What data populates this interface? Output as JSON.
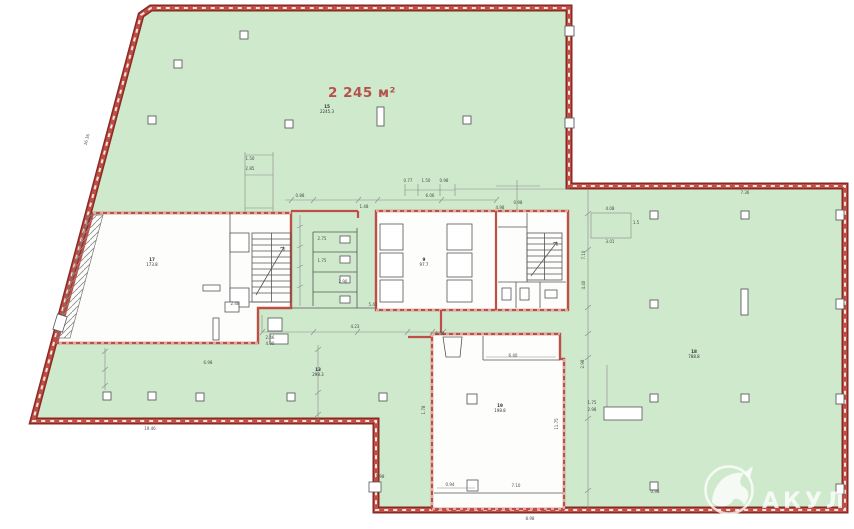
{
  "labels": {
    "area_total": "2 245 м²",
    "watermark": "АКУЛА"
  },
  "colors": {
    "floor_green": "#cfe9cd",
    "wall_red": "#bf4f44",
    "wall_dark": "#8a2a24",
    "annotation_ink": "#4a4a4a",
    "area_label_red": "#b4524c",
    "watermark_white": "#ffffff"
  },
  "room_labels": [
    {
      "x": 327,
      "y": 108,
      "id": "15",
      "area": "2245.3"
    },
    {
      "x": 152,
      "y": 261,
      "id": "17",
      "area": "173.8"
    },
    {
      "x": 424,
      "y": 261,
      "id": "9",
      "area": "97.7"
    },
    {
      "x": 318,
      "y": 371,
      "id": "13",
      "area": "298.3"
    },
    {
      "x": 500,
      "y": 407,
      "id": "19",
      "area": "198.8"
    },
    {
      "x": 694,
      "y": 353,
      "id": "18",
      "area": "788.8"
    }
  ],
  "annotations": [
    {
      "x": 250,
      "y": 160,
      "t": "1.50"
    },
    {
      "x": 250,
      "y": 170,
      "t": "2.85"
    },
    {
      "x": 300,
      "y": 197,
      "t": "0.88"
    },
    {
      "x": 364,
      "y": 208,
      "t": "1.48"
    },
    {
      "x": 430,
      "y": 197,
      "t": "6.06"
    },
    {
      "x": 408,
      "y": 182,
      "t": "0.77"
    },
    {
      "x": 426,
      "y": 182,
      "t": "1.50"
    },
    {
      "x": 444,
      "y": 182,
      "t": "0.98"
    },
    {
      "x": 500,
      "y": 209,
      "t": "4.98"
    },
    {
      "x": 518,
      "y": 204,
      "t": "0.98"
    },
    {
      "x": 513,
      "y": 357,
      "t": "6.40"
    },
    {
      "x": 516,
      "y": 487,
      "t": "7.10"
    },
    {
      "x": 450,
      "y": 486,
      "t": "0.94"
    },
    {
      "x": 440,
      "y": 335,
      "t": "1.88"
    },
    {
      "x": 322,
      "y": 240,
      "t": "2.75"
    },
    {
      "x": 322,
      "y": 262,
      "t": "1.75"
    },
    {
      "x": 343,
      "y": 283,
      "t": "2.90"
    },
    {
      "x": 373,
      "y": 306,
      "t": "5.41"
    },
    {
      "x": 235,
      "y": 305,
      "t": "2.48"
    },
    {
      "x": 270,
      "y": 339,
      "t": "2.46"
    },
    {
      "x": 270,
      "y": 345,
      "t": "4.90"
    },
    {
      "x": 355,
      "y": 328,
      "t": "4.23"
    },
    {
      "x": 208,
      "y": 364,
      "t": "6.98"
    },
    {
      "x": 592,
      "y": 404,
      "t": "1.75"
    },
    {
      "x": 592,
      "y": 411,
      "t": "2.98"
    },
    {
      "x": 610,
      "y": 210,
      "t": "4.08"
    },
    {
      "x": 610,
      "y": 243,
      "t": "3.01"
    },
    {
      "x": 636,
      "y": 224,
      "t": "1.5"
    },
    {
      "x": 745,
      "y": 194,
      "t": "7.36"
    },
    {
      "x": 655,
      "y": 493,
      "t": "0.98"
    },
    {
      "x": 150,
      "y": 430,
      "t": "19.46"
    },
    {
      "x": 530,
      "y": 520,
      "t": "8.98"
    },
    {
      "x": 380,
      "y": 478,
      "t": "1.98"
    },
    {
      "x": 585,
      "y": 255,
      "t": "7.10",
      "r": -90
    },
    {
      "x": 585,
      "y": 285,
      "t": "4.40",
      "r": -90
    },
    {
      "x": 584,
      "y": 364,
      "t": "2.98",
      "r": -90
    },
    {
      "x": 558,
      "y": 424,
      "t": "11.75",
      "r": -90
    },
    {
      "x": 425,
      "y": 410,
      "t": "1.78",
      "r": -90
    },
    {
      "x": 88,
      "y": 140,
      "t": "16.36",
      "r": -75
    }
  ]
}
